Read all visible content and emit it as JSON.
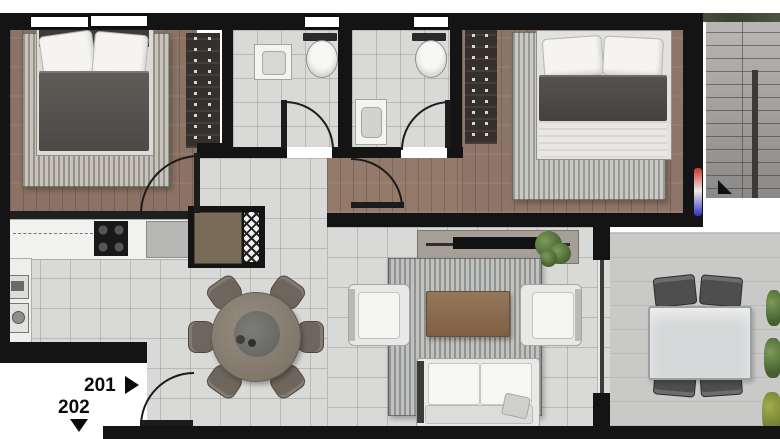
{
  "unit": {
    "label_201": "201",
    "label_202": "202"
  },
  "palette": {
    "wall": "#141414",
    "wood_floor": "#8b7265",
    "tile_floor": "#d9d9d7",
    "balcony_floor": "#c9c9c7",
    "stairs": "#a8a6a4",
    "rug": "#bcbbb6",
    "coffee_table": "#8a6e53",
    "plant_green": "#5e7a42",
    "marker_top_red": "#c8342a",
    "marker_bottom_blue": "#2e2ec8"
  }
}
